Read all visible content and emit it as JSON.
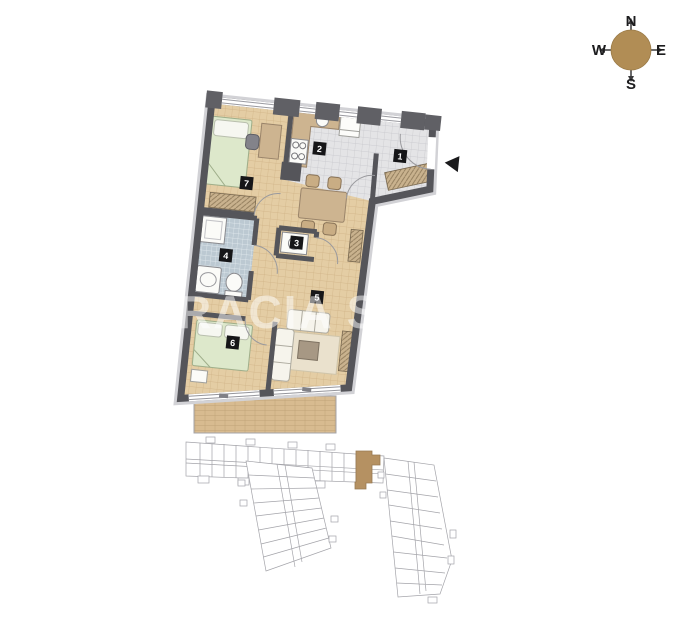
{
  "compass": {
    "north": "N",
    "east": "E",
    "south": "S",
    "west": "W"
  },
  "watermark": {
    "text": "RACIA SA"
  },
  "rooms": [
    {
      "number": "1"
    },
    {
      "number": "2"
    },
    {
      "number": "3"
    },
    {
      "number": "4"
    },
    {
      "number": "5"
    },
    {
      "number": "6"
    },
    {
      "number": "7"
    }
  ],
  "colors": {
    "wall": "#55555a",
    "wood_floor": "#e4cda4",
    "gray_tile_floor": "#e4e4e6",
    "bath_tile_floor": "#bcc9d2",
    "bed_green": "#dde8cb",
    "furniture_brown": "#cdb490",
    "deck": "#d8bb90",
    "compass_brown": "#b18d55",
    "key_plan_highlight": "#ae8652",
    "key_plan_line": "#9b9ba1"
  }
}
